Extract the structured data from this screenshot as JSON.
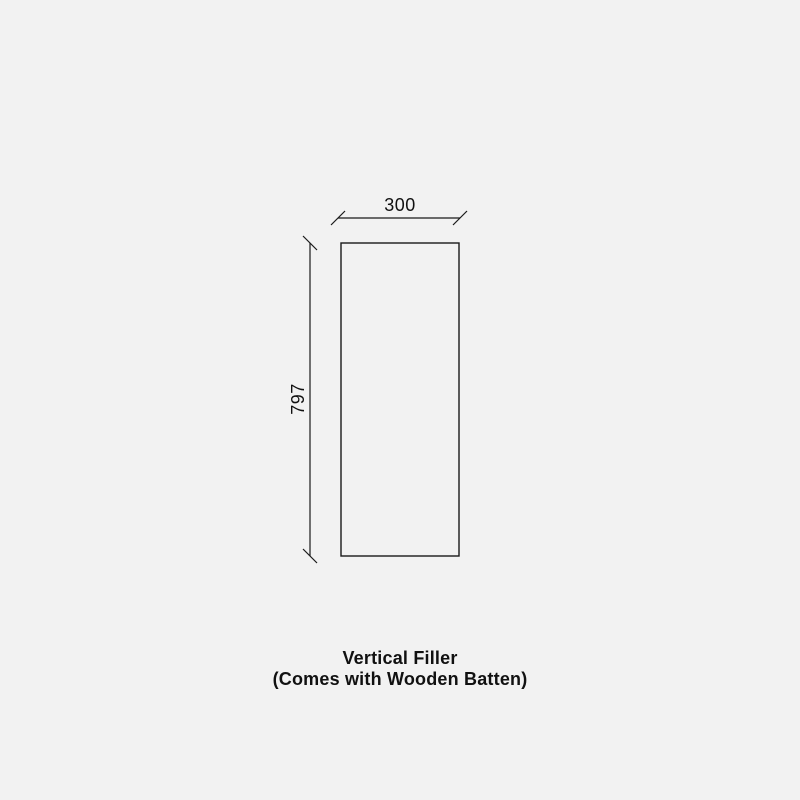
{
  "diagram": {
    "caption": {
      "line1": "Vertical Filler",
      "line2": "(Comes with Wooden Batten)"
    },
    "dimensions": {
      "width_label": "300",
      "height_label": "797"
    },
    "colors": {
      "background": "#f2f2f2",
      "line": "#1a1a1a",
      "text": "#111111"
    }
  }
}
